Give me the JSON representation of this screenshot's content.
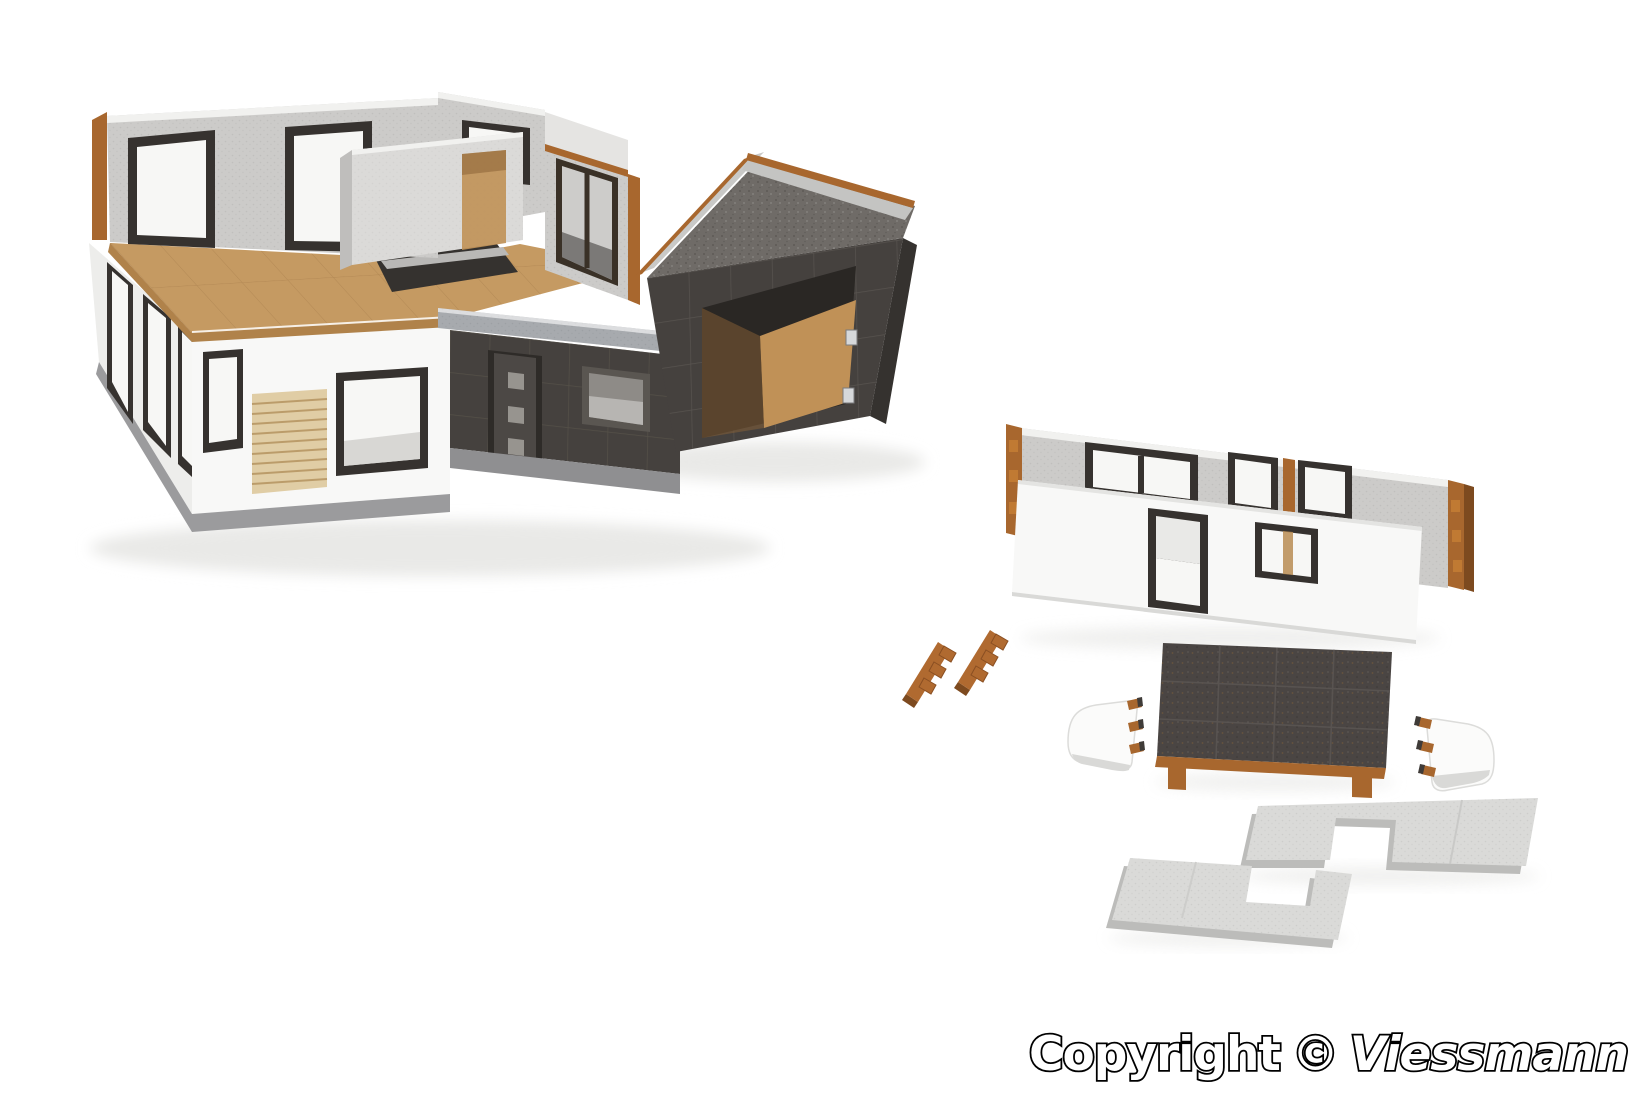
{
  "image_type": "product photo of a model building kit, white studio background",
  "watermark": {
    "prefix": "Copyright",
    "symbol": "©",
    "brand": "Viessmann"
  },
  "scene": {
    "subject": "modern flat-roof model house kit, partially assembled, with loose parts",
    "parts": [
      "assembled house model with open upper floor",
      "attached dark flat-roof garage",
      "wooden upper-floor deck with stairwell opening",
      "anthracite entrance module with door and window",
      "gray exterior wall part with window openings",
      "white exterior wall part with tall and square windows",
      "two small wooden connector strips",
      "anthracite flat roof panel with wooden base rail",
      "two white corner parts with wooden tabs",
      "two light-gray ceiling slabs with rectangular cutouts"
    ]
  },
  "palette": {
    "bg": "#ffffff",
    "white_wall": "#f8f8f7",
    "white_wall_shade": "#ededeb",
    "gray_wall": "#cccbc9",
    "gray_wall_lit": "#dbdad8",
    "wall_top": "#f1f1ef",
    "mdf": "#c59a62",
    "mdf_edge": "#b0824a",
    "wood": "#a8672e",
    "wood_dark": "#7d4a1f",
    "slat": "#e0cda5",
    "slat_line": "#bb9c6a",
    "frame_dark": "#36322f",
    "glass_white": "#f7f7f5",
    "glass_gray": "#cdccca",
    "anthracite": "#45413e",
    "anthracite_dark": "#35322f",
    "anthracite_grid": "#5a5551",
    "door_gray": "#4c4845",
    "coping": "#a7aaae",
    "plinth": "#9b9b9d",
    "gravel": "#6f6b67",
    "slab": "#dadad8",
    "slab_side": "#bcbcba",
    "interior_tan": "#c09157",
    "shadow": "#e9e9e7",
    "deck_line": "#a87f4c",
    "watermark_fill": "#ffffff",
    "watermark_stroke": "#000000"
  }
}
